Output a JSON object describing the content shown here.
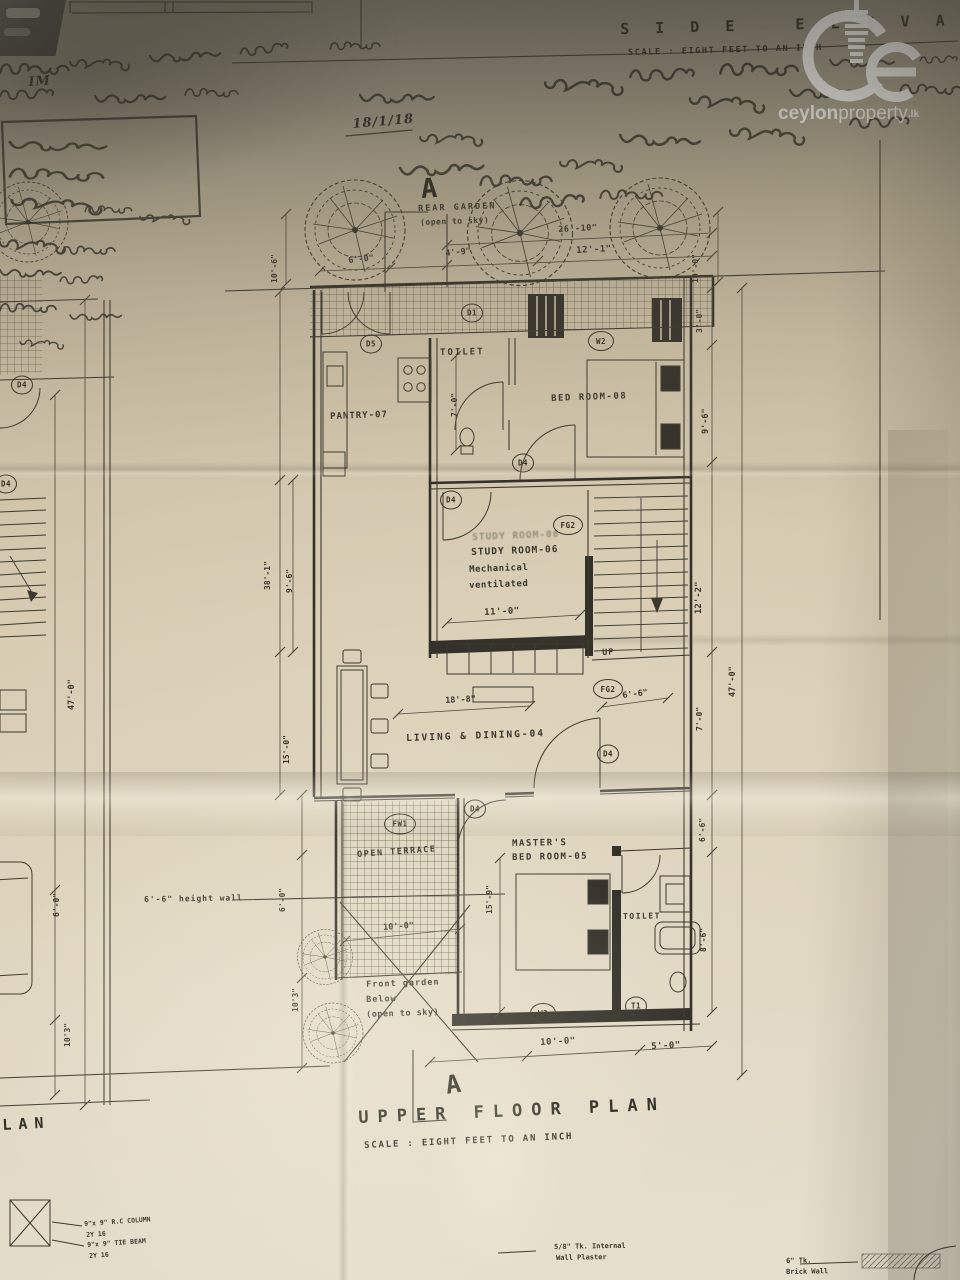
{
  "titles": {
    "side_title": "S I D E   E L E V A T I O N",
    "side_scale": "SCALE : EIGHT FEET TO AN INCH",
    "plan_title": "UPPER FLOOR PLAN",
    "plan_scale": "SCALE : EIGHT FEET TO AN INCH",
    "partial_plan": "LAN",
    "section_letter": "A"
  },
  "watermark": {
    "bold": "ceylon",
    "light": "property",
    "tld": ".lk"
  },
  "rooms": {
    "rear_garden": "REAR GARDEN",
    "rear_garden_sub": "(open to sky)",
    "pantry": "PANTRY-07",
    "toilet_upper": "TOILET",
    "bedroom8": "BED ROOM-08",
    "study": "STUDY ROOM-06",
    "study_note1": "Mechanical",
    "study_note2": "ventilated",
    "living": "LIVING & DINING-04",
    "terrace": "OPEN TERRACE",
    "front_garden1": "Front garden",
    "front_garden2": "Below",
    "front_garden3": "(open to sky)",
    "master1": "MASTER'S",
    "master2": "BED ROOM-05",
    "toilet_lower": "TOILET",
    "up": "UP",
    "wall_note": "6'-6\" height wall"
  },
  "markers": {
    "d5": "D5",
    "d1": "D1",
    "w2": "W2",
    "d4": "D4",
    "fg2": "FG2",
    "fw1": "FW1",
    "w3": "W3",
    "t1": "T1"
  },
  "dims": {
    "garden_w_total": "26'-10\"",
    "garden_w1": "12'-1\"",
    "garden_w2": "4'-9\"",
    "garden_w3": "6'-0\"",
    "garden_left_h": "10'-6\"",
    "garden_right_h": "10'-0\"",
    "right_3_0": "3'-0\"",
    "right_9_6": "9'-6\"",
    "right_12_2": "12'-2\"",
    "right_47_0": "47'-0\"",
    "right_7_0": "7'-0\"",
    "right_6_6": "6'-6\"",
    "right_8_6": "8'-6\"",
    "left_38_1": "38'-1\"",
    "left_9_6": "9'-6\"",
    "left_15_0": "15'-0\"",
    "left_6_0": "6'-0\"",
    "left_10_3": "10'3\"",
    "toilet_h": "7'-0\"",
    "study_w": "11'-0\"",
    "living_w": "18'-8\"",
    "stair_6_6": "6'-6\"",
    "master_h": "15'-9\"",
    "terrace_w": "10'-0\"",
    "bottom_10_0": "10'-0\"",
    "bottom_5_0": "5'-0\"",
    "lsheet_47_0": "47'-0\"",
    "lsheet_6_0": "6'-0\"",
    "lsheet_10_3": "10'3\""
  },
  "notes": {
    "rc_column": "9\"x 9\" R.C COLUMN",
    "rc_bars": "2Y 16",
    "tie_beam": "9\"x 9\" TIE BEAM",
    "tie_bars": "2Y 16",
    "plaster1": "5/8\" Tk. Internal",
    "plaster2": "Wall Plaster",
    "brick1": "6\" Tk.",
    "brick2": "Brick Wall"
  },
  "handwriting": {
    "mark": "IM",
    "date": "18/1/18"
  }
}
